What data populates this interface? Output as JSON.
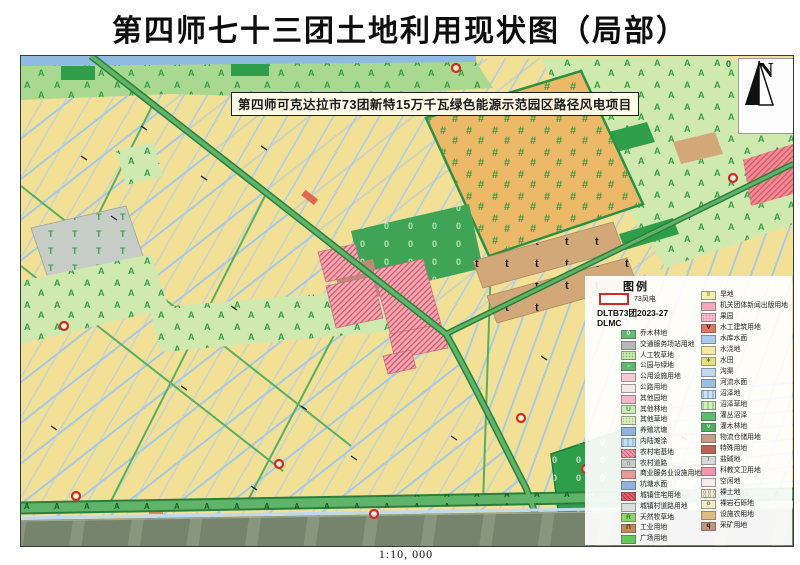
{
  "title": "第四师七十三团土地利用现状图（局部）",
  "map": {
    "project_label": "第四师可克达拉市73团新特15万千瓦绿色能源示范园区路径风电项目",
    "north_label": "N",
    "scale_text": "1:10, 000"
  },
  "legend": {
    "header": "图例",
    "special": {
      "label": "73风电",
      "border_color": "#D42B20"
    },
    "code_line": "DLTB73团2023-27",
    "field_line": "DLMC",
    "left": [
      {
        "label": "乔木林地",
        "color": "#5FBC70",
        "sym": "0",
        "symColor": "#EEF7D8"
      },
      {
        "label": "交通服务场站用地",
        "color": "#B6BAB6"
      },
      {
        "label": "人工牧草地",
        "color": "#CDEBB0",
        "pattern": "dots",
        "pcolor": "#7DBE62"
      },
      {
        "label": "公园与绿地",
        "color": "#5BB96B",
        "sym": "▫",
        "symColor": "#FFFFFF"
      },
      {
        "label": "公用设施用地",
        "color": "#F3CBD6"
      },
      {
        "label": "公路用地",
        "color": "#F6E6EA"
      },
      {
        "label": "其他园地",
        "color": "#F3B8C8"
      },
      {
        "label": "其他林地",
        "color": "#CBE9B2",
        "sym": "U",
        "symColor": "#3E9C50"
      },
      {
        "label": "其他草地",
        "color": "#DDF0C2",
        "pattern": "dots",
        "pcolor": "#9CCB7A"
      },
      {
        "label": "养殖坑塘",
        "color": "#8FB3DB"
      },
      {
        "label": "内陆滩涂",
        "color": "#C5DEF2",
        "pattern": "dash",
        "pcolor": "#9CC2E4"
      },
      {
        "label": "农村宅基地",
        "color": "#ED9CA8",
        "pattern": "hatch",
        "pcolor": "#D9606E"
      },
      {
        "label": "农村道路",
        "color": "#C6CAC6",
        "sym": "∩",
        "symColor": "#444444"
      },
      {
        "label": "商业服务业设施用地",
        "color": "#E79B94"
      },
      {
        "label": "坑塘水面",
        "color": "#8FB3DB"
      },
      {
        "label": "城镇住宅用地",
        "color": "#E4606C",
        "pattern": "hatch",
        "pcolor": "#B93945"
      },
      {
        "label": "城镇村道路用地",
        "color": "#DADEDA"
      },
      {
        "label": "天然牧草地",
        "color": "#90D466",
        "sym": "R",
        "symColor": "#2B7F3C"
      },
      {
        "label": "工业用地",
        "color": "#C08A56",
        "sym": "Π",
        "symColor": "#333333"
      },
      {
        "label": "广场用地",
        "color": "#66C657"
      }
    ],
    "right": [
      {
        "label": "旱地",
        "color": "#F7F0AC",
        "sym": "‖",
        "symColor": "#8A8A4A"
      },
      {
        "label": "机关团体新闻出版用地",
        "color": "#F2AABA"
      },
      {
        "label": "果园",
        "color": "#F5BFCD",
        "pattern": "dots",
        "pcolor": "#E08AA0"
      },
      {
        "label": "水工建筑用地",
        "color": "#E8745C",
        "sym": "V",
        "symColor": "#111111"
      },
      {
        "label": "水库水面",
        "color": "#A9CDEA"
      },
      {
        "label": "水浇地",
        "color": "#F5E9A2"
      },
      {
        "label": "水田",
        "color": "#F1DD7E",
        "sym": "∗",
        "symColor": "#3E9C50"
      },
      {
        "label": "沟渠",
        "color": "#BFD9F1"
      },
      {
        "label": "河流水面",
        "color": "#97C2E6"
      },
      {
        "label": "沼泽地",
        "color": "#CAE2F2",
        "pattern": "dash",
        "pcolor": "#9CC2E4"
      },
      {
        "label": "沼泽草地",
        "color": "#D6EEC6",
        "pattern": "dash",
        "pcolor": "#A8D494"
      },
      {
        "label": "灌丛沼泽",
        "color": "#5CBB6C"
      },
      {
        "label": "灌木林地",
        "color": "#4CAE5C",
        "sym": "v",
        "symColor": "#E8F5E0"
      },
      {
        "label": "物流仓储用地",
        "color": "#C79C88"
      },
      {
        "label": "特殊用地",
        "color": "#BB6353"
      },
      {
        "label": "盐碱地",
        "color": "#D6DAD6",
        "sym": "T",
        "symColor": "#8A8A8A"
      },
      {
        "label": "科教文卫用地",
        "color": "#F595AC"
      },
      {
        "label": "空闲地",
        "color": "#F9EAEE"
      },
      {
        "label": "裸土地",
        "color": "#F1EADB",
        "pattern": "rings",
        "pcolor": "#B09468"
      },
      {
        "label": "裸岩石砾地",
        "color": "#F2EEC4",
        "sym": "o",
        "symColor": "#8A7A4A"
      },
      {
        "label": "设施农用地",
        "color": "#DFBC7E"
      },
      {
        "label": "采矿用地",
        "color": "#C29480",
        "sym": "q",
        "symColor": "#111111"
      }
    ]
  }
}
